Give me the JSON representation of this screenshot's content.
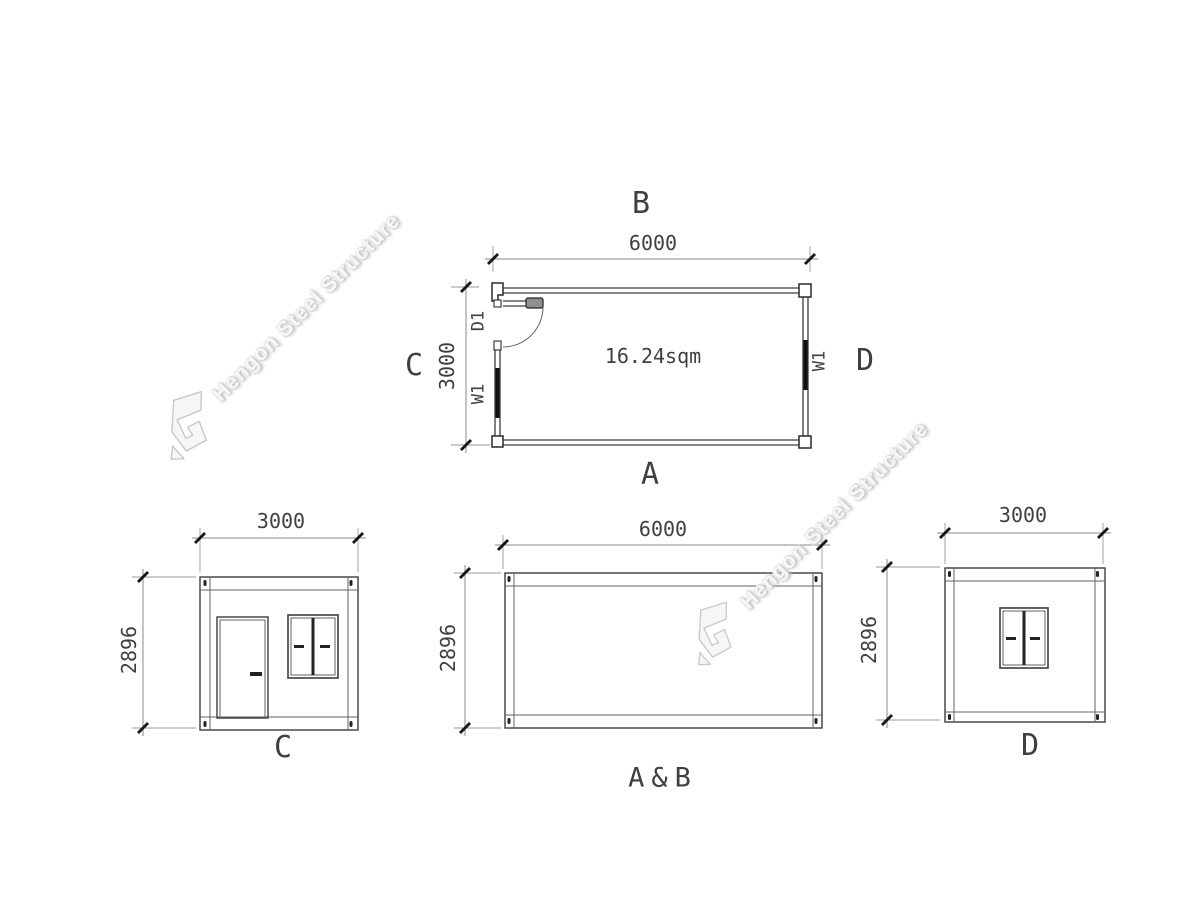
{
  "watermark": {
    "text": "Hengon Steel Structure"
  },
  "floor_plan": {
    "side_labels": {
      "top": "B",
      "bottom": "A",
      "left": "C",
      "right": "D"
    },
    "width_dim": "6000",
    "depth_dim": "3000",
    "area": "16.24sqm",
    "door_tag": "D1",
    "window_tag_left": "W1",
    "window_tag_right": "W1"
  },
  "elevations": {
    "c": {
      "title": "C",
      "width_dim": "3000",
      "height_dim": "2896"
    },
    "ab": {
      "title": "A&B",
      "width_dim": "6000",
      "height_dim": "2896"
    },
    "d": {
      "title": "D",
      "width_dim": "3000",
      "height_dim": "2896"
    }
  }
}
